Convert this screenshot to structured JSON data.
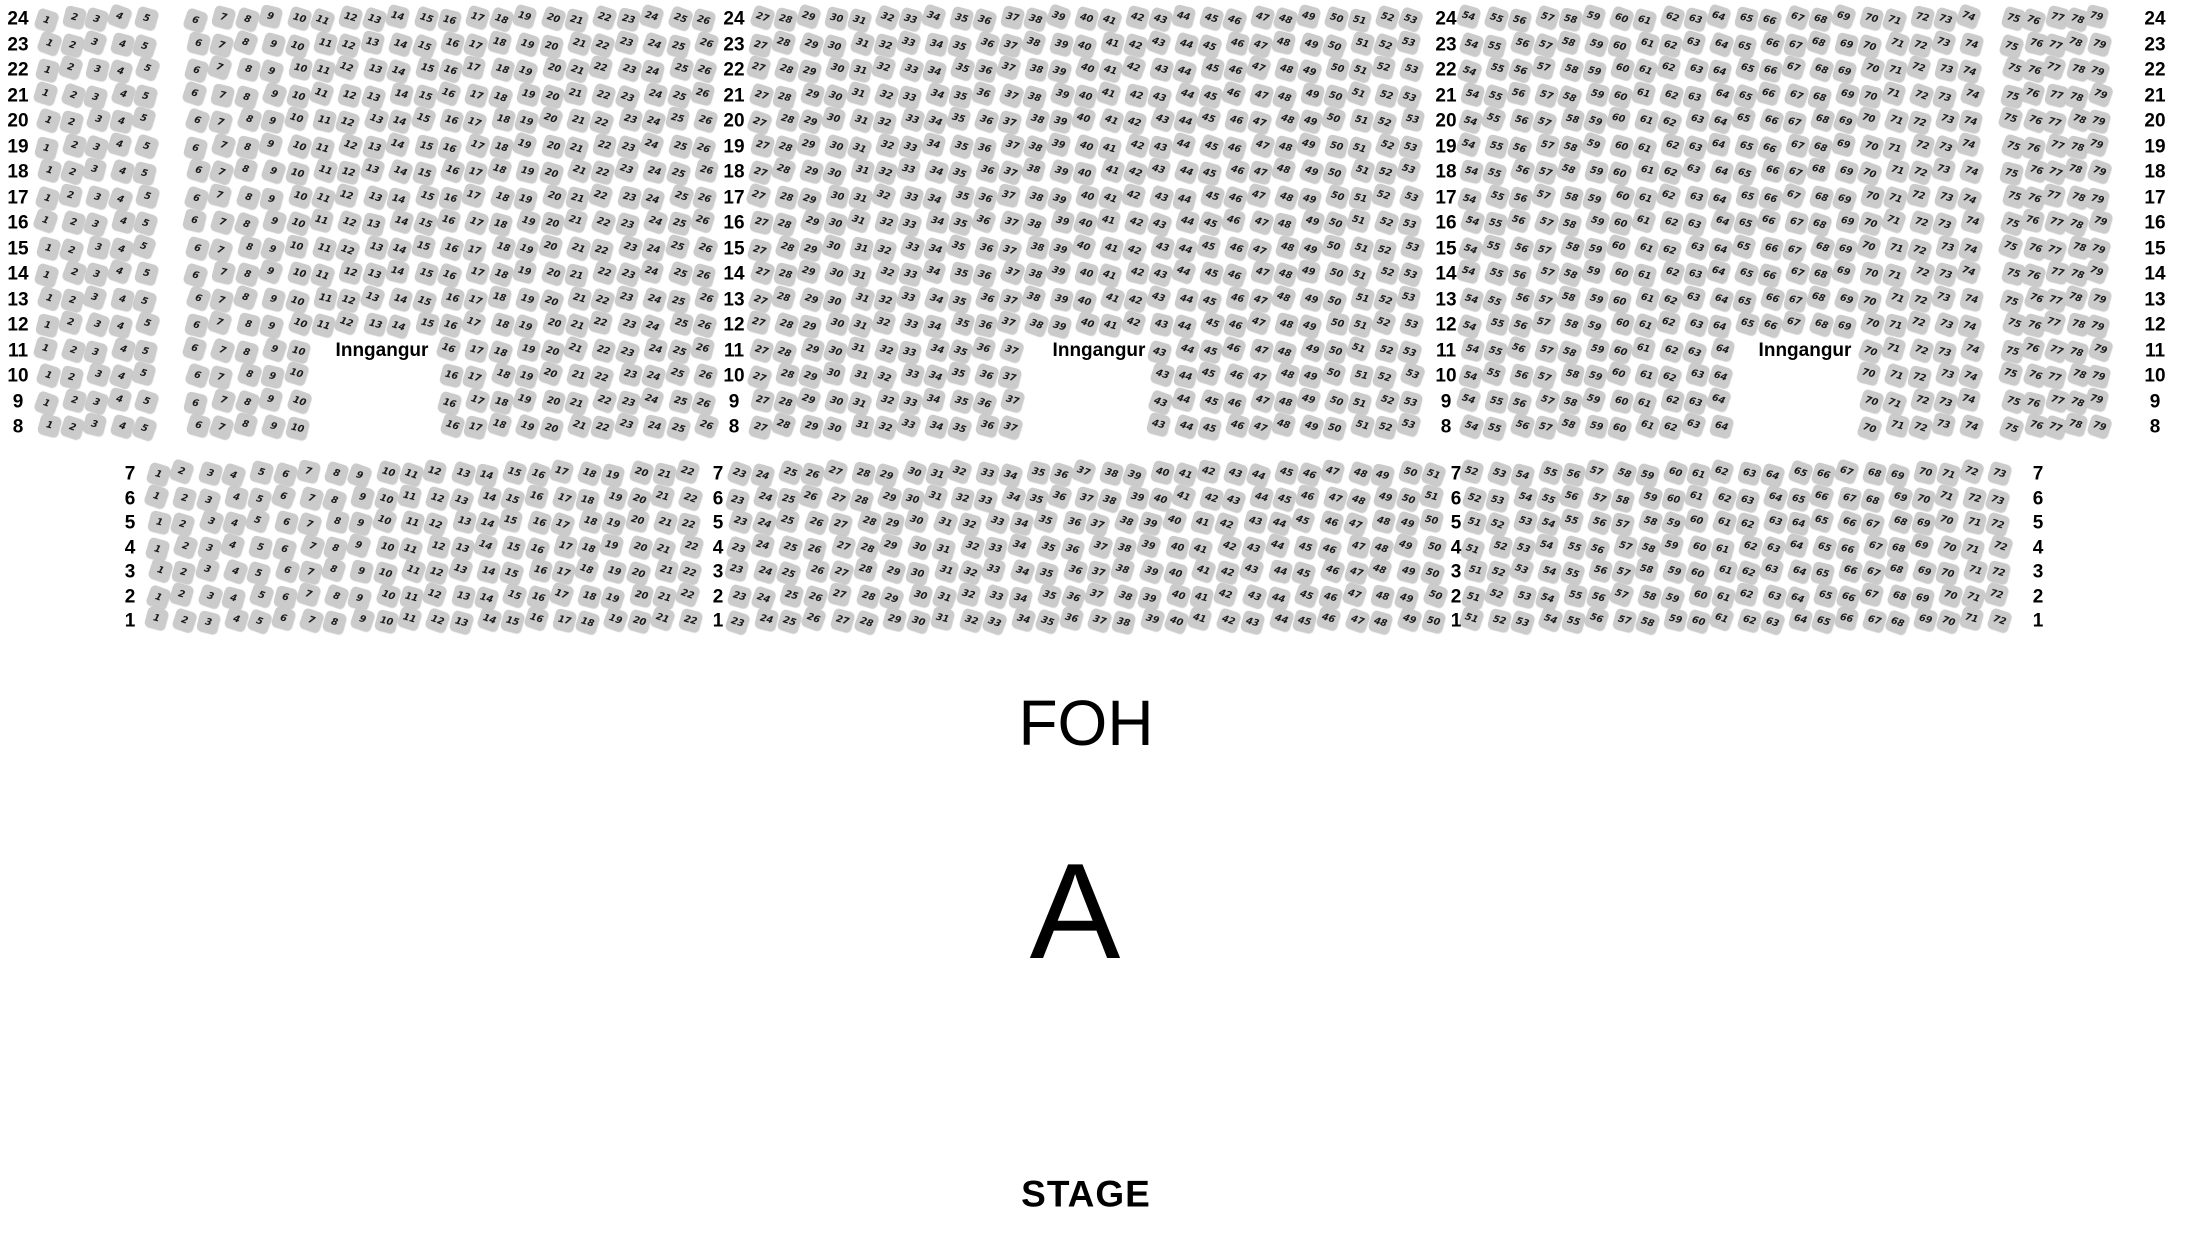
{
  "labels": {
    "entrance": "Inngangur",
    "foh": "FOH",
    "section_letter": "A",
    "stage": "STAGE"
  },
  "colors": {
    "background": "#ffffff",
    "seat_fill": "#cbcbcb",
    "seat_number": "#1a1a1a",
    "label_text": "#000000"
  },
  "upper_section": {
    "row_from": 24,
    "row_to": 8,
    "entrance_row_from": 11,
    "entrance_row_to": 8,
    "blocks": [
      {
        "seat_from": 1,
        "seat_to": 5
      },
      {
        "seat_from": 6,
        "seat_to": 26,
        "gap_from": 11,
        "gap_to": 15,
        "entrance": true
      },
      {
        "seat_from": 27,
        "seat_to": 53,
        "gap_from": 38,
        "gap_to": 42,
        "entrance": true
      },
      {
        "seat_from": 54,
        "seat_to": 74,
        "gap_from": 65,
        "gap_to": 69,
        "entrance": true
      },
      {
        "seat_from": 75,
        "seat_to": 79
      }
    ]
  },
  "lower_section": {
    "row_from": 7,
    "row_to": 1,
    "full_rows": [
      7,
      6
    ],
    "blocks": [
      {
        "seat_from": 1,
        "seat_to": 22,
        "seat_from_short": 1,
        "seat_to_short": 22
      },
      {
        "seat_from": 23,
        "seat_to": 51,
        "seat_from_short": 23,
        "seat_to_short": 50
      },
      {
        "seat_from": 52,
        "seat_to": 73,
        "seat_from_short": 51,
        "seat_to_short": 72
      }
    ]
  }
}
